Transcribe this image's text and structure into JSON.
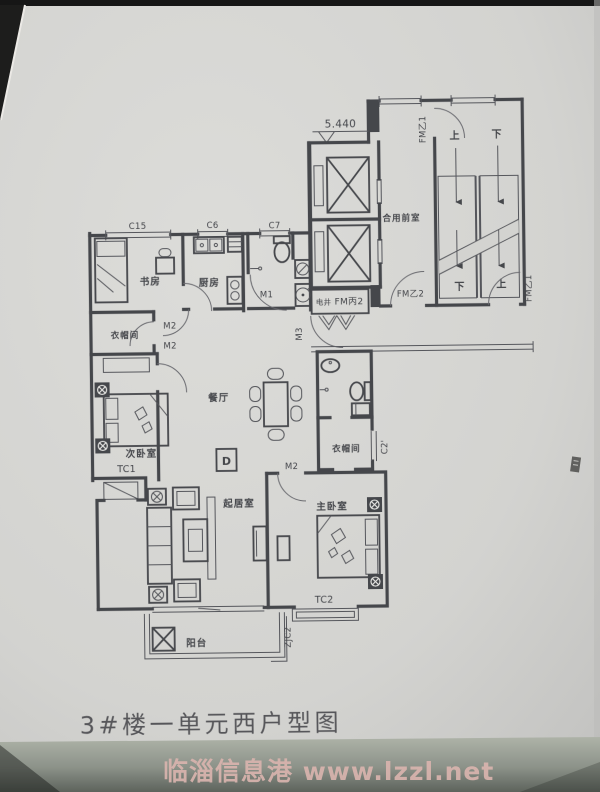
{
  "photo": {
    "title": "3#楼一单元西户型图",
    "watermark": "临淄信息港 www.lzzl.net"
  },
  "colors": {
    "paper": "#d5d4d1",
    "ink": "#45464b",
    "title": "#57575a",
    "wm": "#d9b4ae",
    "foot1": "#adb2a7",
    "foot2": "#5f655e"
  },
  "labels": {
    "title": "3#楼一单元西户型图",
    "watermark": "临淄信息港 www.lzzl.net",
    "elevation": "5.440",
    "c10_left": "C10",
    "c10_right": "C10",
    "fmy1_top": "FM乙1",
    "fmy1_bottom": "FM乙1",
    "fmy2": "FM乙2",
    "fmb2": "FM丙2",
    "dianjing": "电井",
    "lobby": "合用前室",
    "up_top": "上",
    "down_top": "下",
    "down_bottom": "下",
    "up_bottom": "上",
    "c15": "C15",
    "c6": "C6",
    "c7": "C7",
    "c2p": "C2'",
    "m1": "M1",
    "m2_study": "M2",
    "m2_cloak": "M2",
    "m2_master": "M2",
    "m3": "M3",
    "tc1": "TC1",
    "tc2": "TC2",
    "zjc2": "ZJC2",
    "study": "书房",
    "kitchen": "厨房",
    "cloak1": "衣帽间",
    "bed2": "次卧室",
    "dining": "餐厅",
    "living": "起居室",
    "master": "主卧室",
    "cloak2": "衣帽间",
    "balcony": "阳台",
    "unit": "D"
  }
}
